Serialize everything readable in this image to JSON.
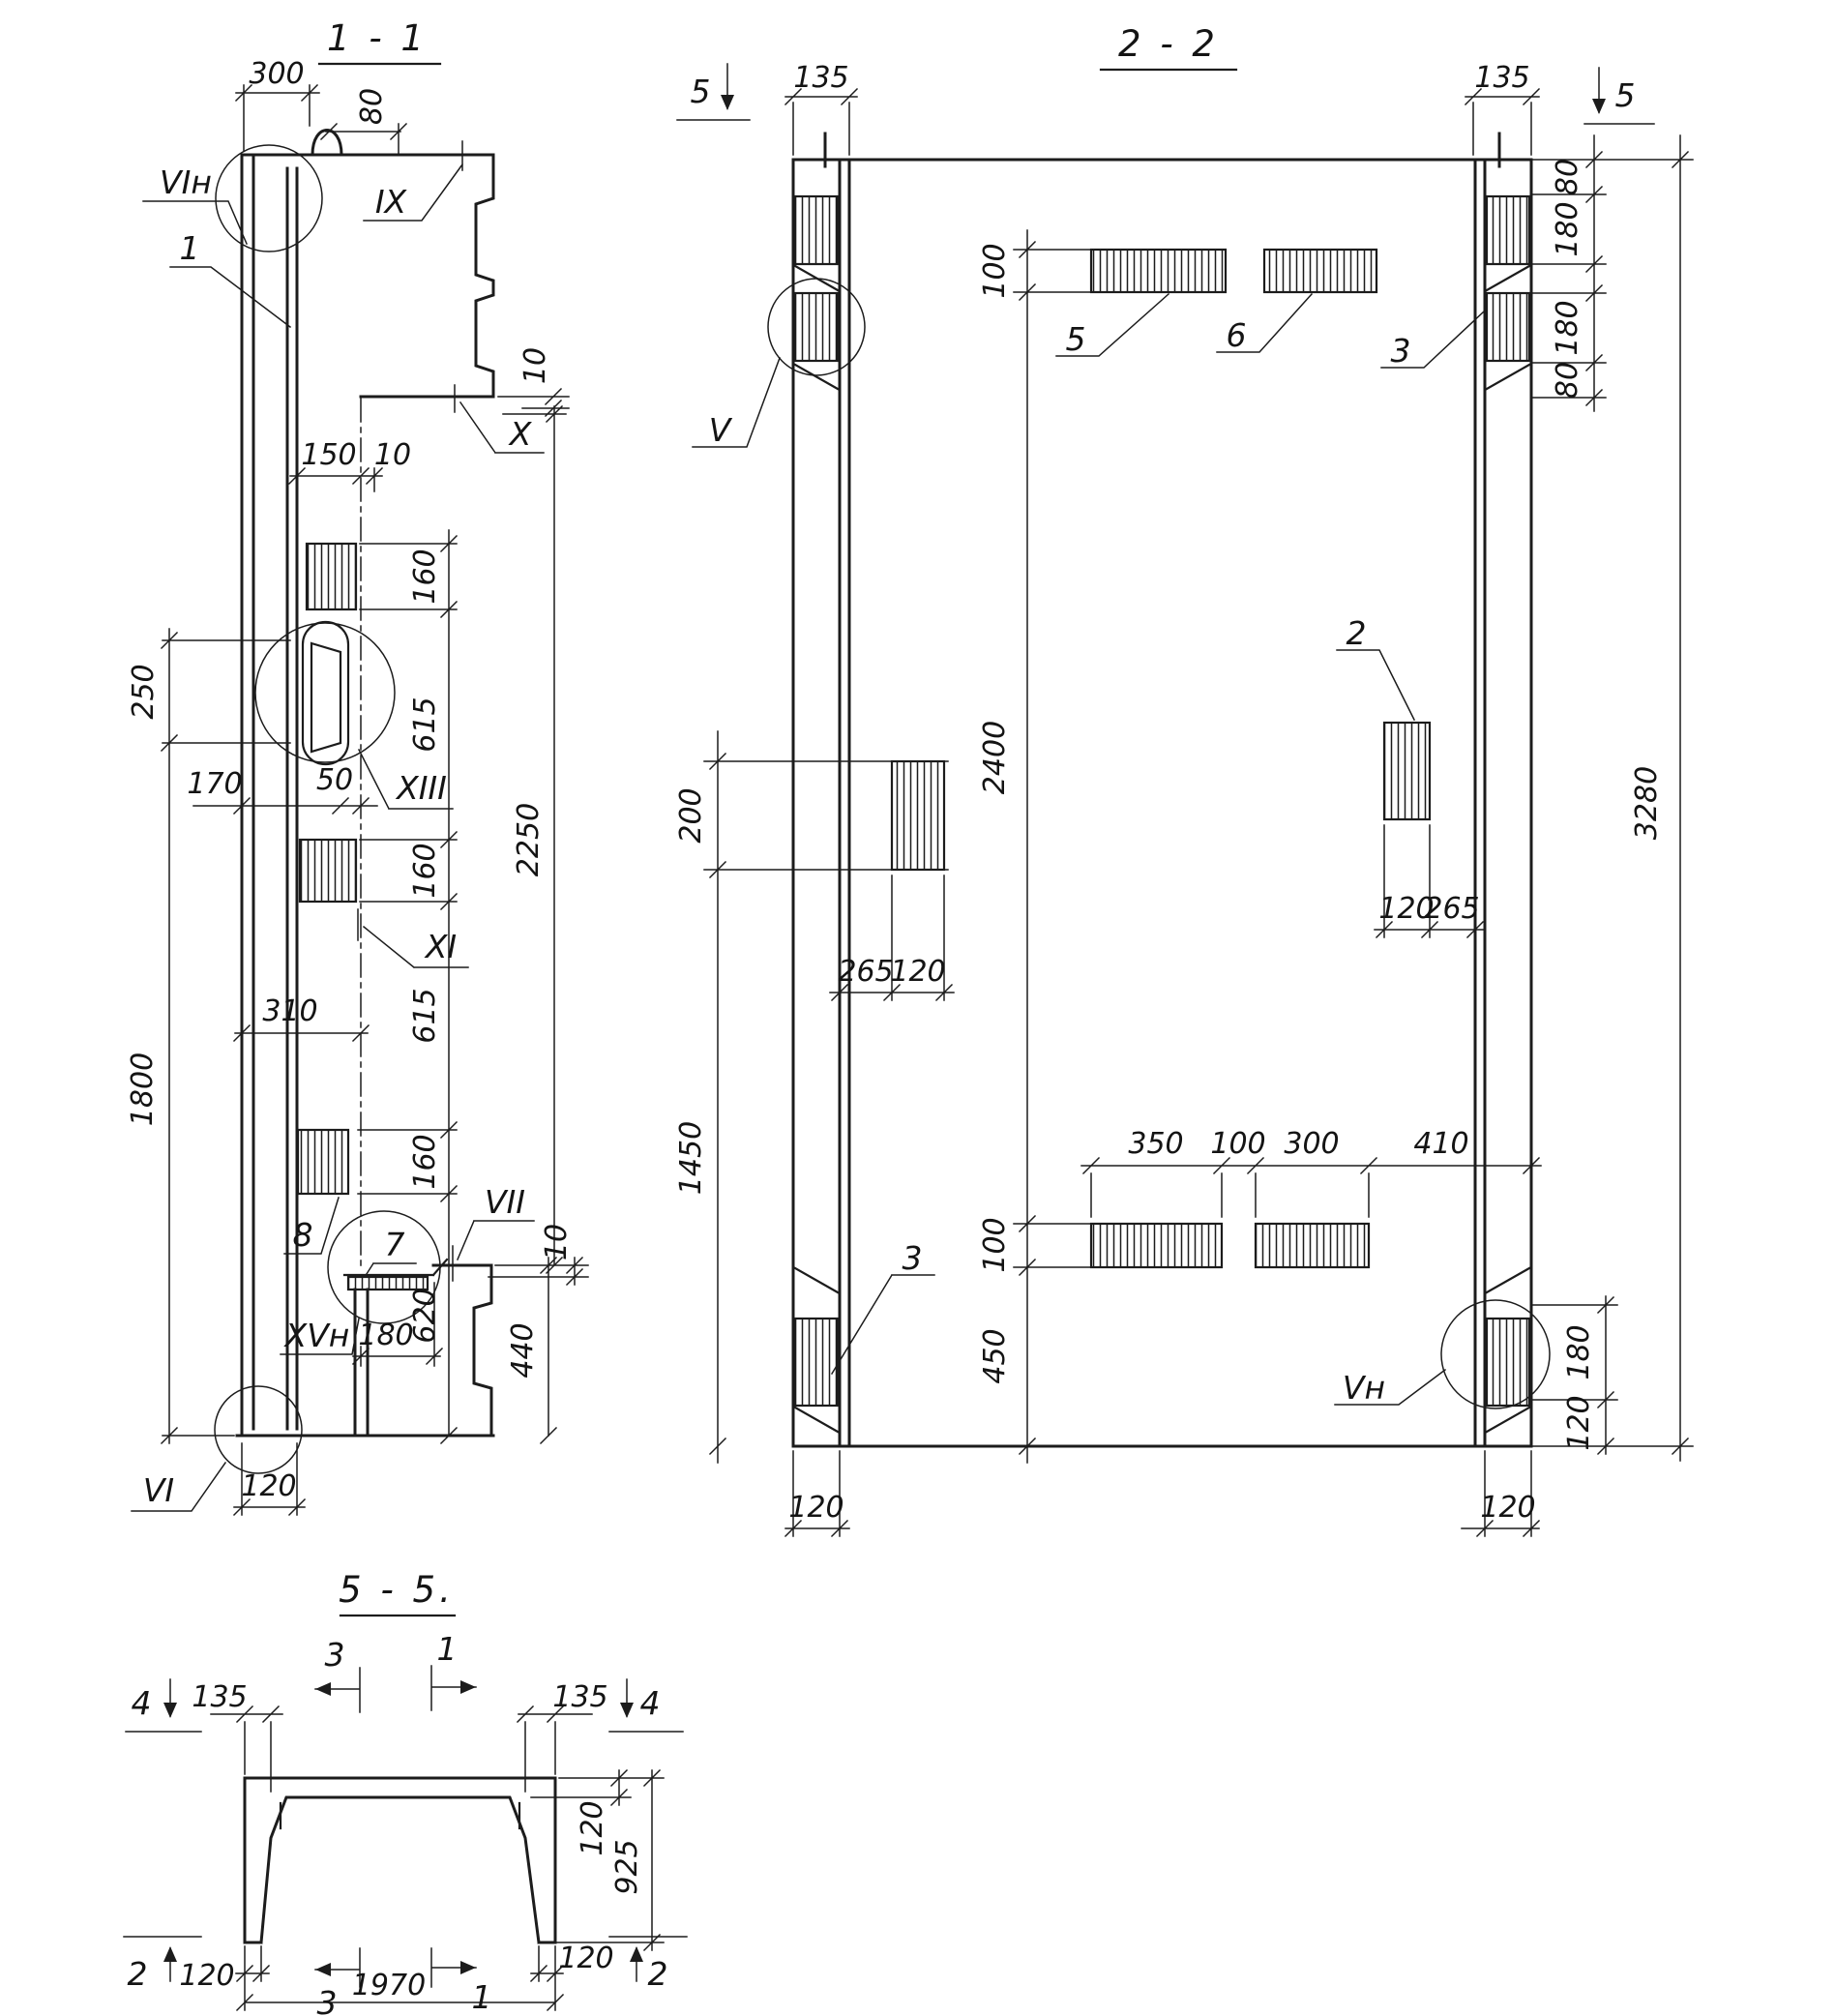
{
  "page": {
    "background": "#ffffff",
    "ink": "#1c1c1c"
  },
  "s11": {
    "title": "1 - 1",
    "dims": {
      "d300": "300",
      "d80": "80",
      "d10_top": "10",
      "d150": "150",
      "d10_mid": "10",
      "d160_1": "160",
      "d615_1": "615",
      "d160_2": "160",
      "d615_2": "615",
      "d160_3": "160",
      "d620": "620",
      "d2250": "2250",
      "d250": "250",
      "d170": "170",
      "d50": "50",
      "d310": "310",
      "d1800": "1800",
      "d180": "180",
      "d440": "440",
      "d10_bot": "10",
      "d120": "120"
    },
    "labels": {
      "vin": "VIн",
      "p1": "1",
      "ix": "IX",
      "x": "X",
      "xiii": "XIII",
      "xi": "XI",
      "p8": "8",
      "p7": "7",
      "vii": "VII",
      "xvn": "XVн",
      "vi": "VI"
    }
  },
  "s22": {
    "title": "2 - 2",
    "markers": {
      "m5l": "5",
      "m5r": "5"
    },
    "dims": {
      "d135l": "135",
      "d135r": "135",
      "d80t": "80",
      "d180t": "180",
      "d180b": "180",
      "d80b": "80",
      "d3280": "3280",
      "d100t": "100",
      "d2400": "2400",
      "d100b": "100",
      "d450": "450",
      "d200": "200",
      "d1450": "1450",
      "d265l": "265",
      "d120l": "120",
      "d120r": "120",
      "d265r": "265",
      "d350": "350",
      "d100m": "100",
      "d300": "300",
      "d410": "410",
      "d180r": "180",
      "d120rb": "120",
      "d120bl": "120",
      "d120br": "120"
    },
    "labels": {
      "v": "V",
      "vn": "Vн",
      "p5": "5",
      "p6": "6",
      "p3t": "3",
      "p2": "2",
      "p3b": "3"
    }
  },
  "s55": {
    "title": "5 - 5.",
    "markers": {
      "m4l": "4",
      "m4r": "4",
      "m2l": "2",
      "m2r": "2",
      "m3t": "3",
      "m1t": "1",
      "m3b": "3",
      "m1b": "1"
    },
    "dims": {
      "d135l": "135",
      "d135r": "135",
      "d120t": "120",
      "d925": "925",
      "d120bl": "120",
      "d120br": "120",
      "d1970": "1970"
    }
  }
}
